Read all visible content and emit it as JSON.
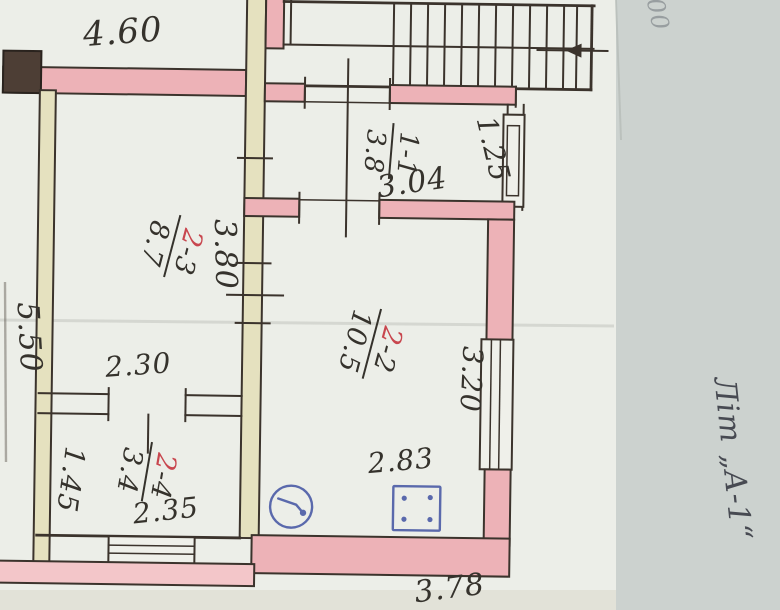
{
  "document": {
    "building_label": "Літ „А-1“",
    "corner_note": "00"
  },
  "rooms": [
    {
      "num_first": "1",
      "num_rest": "-1",
      "area": "3.8",
      "number_color": "dark"
    },
    {
      "num_first": "2",
      "num_rest": "-3",
      "area": "8.7",
      "number_color": "red"
    },
    {
      "num_first": "2",
      "num_rest": "-2",
      "area": "10.5",
      "number_color": "red"
    },
    {
      "num_first": "2",
      "num_rest": "-4",
      "area": "3.4",
      "number_color": "red"
    }
  ],
  "dimensions": {
    "top_width": "4.60",
    "stair_room_width": "3.04",
    "stair_room_depth": "1.25",
    "living_room_depth": "3.80",
    "left_side_height": "5.50",
    "living_room_width": "2.30",
    "small_room_depth": "1.45",
    "small_room_width": "2.35",
    "hall_right_depth": "3.20",
    "hall_width": "2.83",
    "bottom_width": "3.78"
  },
  "symbols": {
    "gas_meter_icon": "circle-with-hook-pointer",
    "gas_stove_icon": "rectangle-with-four-burner-dots",
    "stairs": "parallel-tread-lines-with-direction-arrow"
  },
  "colors": {
    "wall_fill": "#edb2b7",
    "partition_fill": "#e5e1bf",
    "outline_ink": "#3b332c",
    "handwriting_ink": "#35322c",
    "red_ink": "#c8464e",
    "blue_ink": "#5a69ac",
    "plan_paper": "#eceee8",
    "background_paper": "#ccd1cd"
  }
}
